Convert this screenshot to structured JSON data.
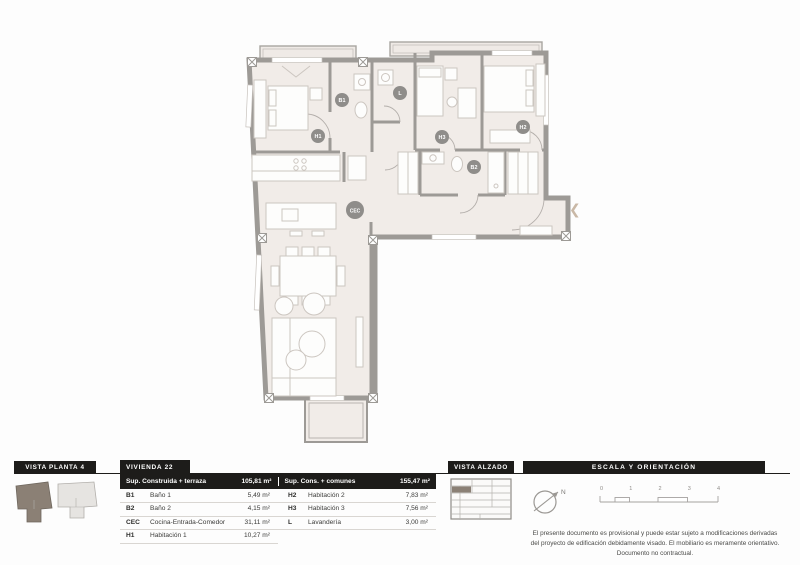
{
  "page": {
    "type_label": "floor-plan-sheet"
  },
  "plan": {
    "labels": [
      {
        "text": "H1"
      },
      {
        "text": "B1"
      },
      {
        "text": "L"
      },
      {
        "text": "H3"
      },
      {
        "text": "H2"
      },
      {
        "text": "B2"
      },
      {
        "text": "CEC"
      }
    ],
    "entry_chevron": "❮"
  },
  "vista_planta": {
    "title": "VISTA PLANTA 4"
  },
  "unit_table": {
    "title": "VIVIENDA 22",
    "header": {
      "left_label": "Sup. Construida + terraza",
      "left_value": "105,81 m²",
      "right_label": "Sup. Cons. + comunes",
      "right_value": "155,47 m²"
    },
    "rows": [
      {
        "code": "B1",
        "name": "Baño 1",
        "value": "5,49 m²",
        "code2": "H2",
        "name2": "Habitación 2",
        "value2": "7,83 m²"
      },
      {
        "code": "B2",
        "name": "Baño 2",
        "value": "4,15 m²",
        "code2": "H3",
        "name2": "Habitación 3",
        "value2": "7,56 m²"
      },
      {
        "code": "CEC",
        "name": "Cocina-Entrada-Comedor",
        "value": "31,11 m²",
        "code2": "L",
        "name2": "Lavandería",
        "value2": "3,00 m²"
      },
      {
        "code": "H1",
        "name": "Habitación 1",
        "value": "10,27 m²",
        "code2": "",
        "name2": "",
        "value2": ""
      }
    ]
  },
  "vista_alzado": {
    "title": "VISTA ALZADO"
  },
  "escala": {
    "title": "ESCALA Y ORIENTACIÓN",
    "north_label": "N",
    "ticks": [
      "0",
      "1",
      "2",
      "3",
      "4"
    ]
  },
  "disclaimer": {
    "line1": "El presente documento es provisional y puede estar sujeto a modificaciones derivadas",
    "line2": "del proyecto de edificación debidamente visado. El mobiliario es meramente orientativo.",
    "line3": "Documento no contractual."
  },
  "colors": {
    "header_bg": "#1d1c1a",
    "wall": "#9d9a96",
    "floor": "#f1ece8",
    "highlight_unit": "#8b8075",
    "label_circle": "#8f8d8a",
    "chevron": "#c9b8a6"
  }
}
